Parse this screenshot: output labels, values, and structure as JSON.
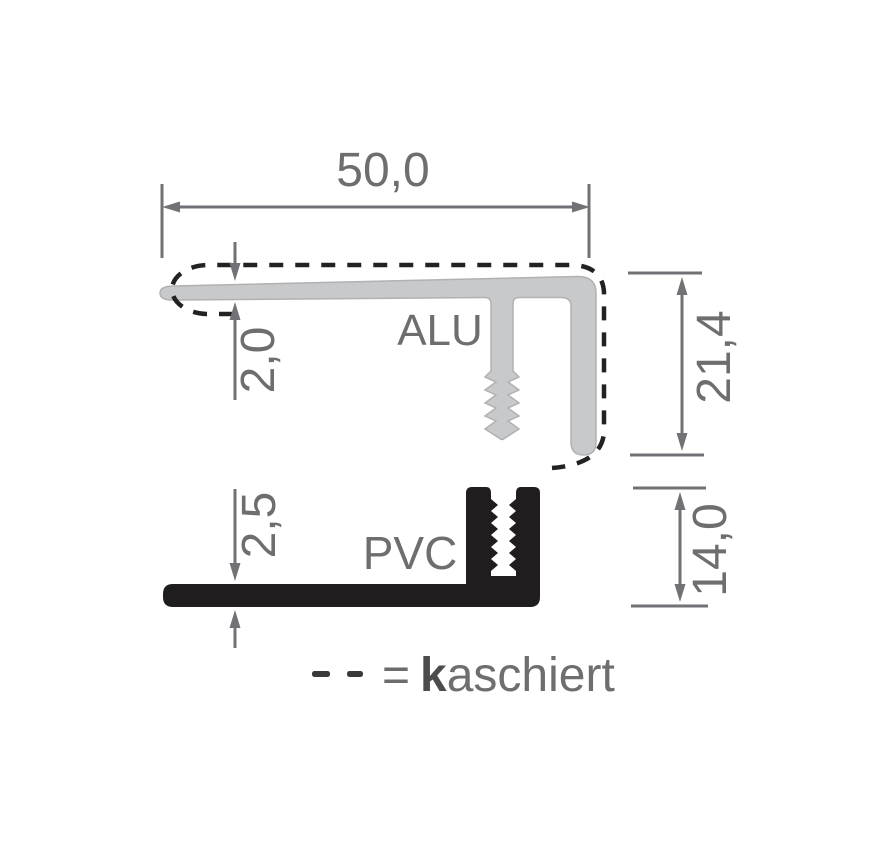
{
  "diagram": {
    "alu_label": "ALU",
    "pvc_label": "PVC",
    "dimensions": {
      "total_width": "50,0",
      "alu_thickness": "2,0",
      "alu_height": "21,4",
      "pvc_thickness": "2,5",
      "pvc_height": "14,0"
    },
    "legend": {
      "equals_sign": "=",
      "term_initial": "k",
      "term_rest": "aschiert"
    }
  },
  "colors": {
    "background": "#ffffff",
    "alu_fill": "#c8c9cb",
    "alu_stroke": "#b0b1b3",
    "pvc_fill": "#201d1e",
    "dim_color": "#717275",
    "text_color": "#6d6e70",
    "dash_color": "#222222",
    "legend_dash_color": "#3a3a3a",
    "equals_color": "#6b6c6e",
    "legend_bold_color": "#4c4c4e"
  }
}
